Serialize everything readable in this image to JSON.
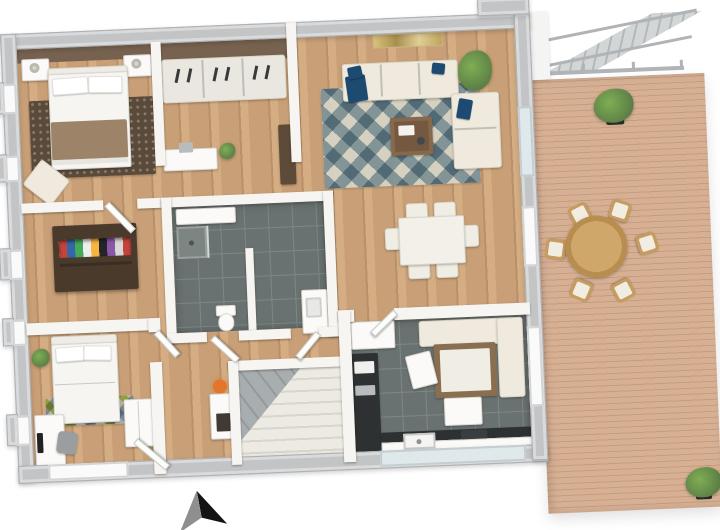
{
  "document": {
    "kind": "3d-floor-plan-rendering",
    "view": "top-down-perspective",
    "visible_text": "none"
  },
  "orientation": {
    "marker": "north-arrow",
    "direction": "up"
  },
  "colors": {
    "background": "#ffffff",
    "exterior_wall": "#c2c4c6",
    "interior_wall": "#f6f5f2",
    "wood_floor": "#c89f76",
    "wood_dark": "#b9906a",
    "wood_light": "#d4ad83",
    "deck_floor": "#d7b094",
    "deck_line": "#c49e82",
    "tile_floor": "#6a7271",
    "tile_grout": "#7e8784",
    "counter_dark": "#2d3132",
    "cream": "#efeadd",
    "navy": "#1d4a70",
    "rug_blue": "#8ba3ad",
    "rug_cream": "#eae8e0",
    "master_rug": "#5a4a3b",
    "brown_wall": "#77624f",
    "dark_wardrobe": "#4a3a2c",
    "table_brown": "#8a6e50",
    "outdoor_wood": "#c79c5e",
    "plant_green": "#5c7f46",
    "plant_light": "#7fae54",
    "lamp_orange": "#e2762d",
    "stair_gray": "#a8adaf",
    "stair_cream": "#eceae3",
    "arrow_black": "#141414",
    "arrow_gray": "#8f8f8f",
    "blanket": "#9d8469",
    "glass": "#dfe9ec"
  },
  "rooms": [
    {
      "id": "master-bedroom",
      "floor": "wood",
      "furniture": [
        "double-bed",
        "pillows",
        "taupe-blanket",
        "headboard-accent-wall",
        "nightstand-left",
        "nightstand-right",
        "table-lamps",
        "dark-patterned-rug",
        "armchair"
      ]
    },
    {
      "id": "walk-in-closet",
      "floor": "wood",
      "furniture": [
        "sliding-door-wardrobe",
        "sideboard",
        "storage-box",
        "plant",
        "tall-cabinet"
      ]
    },
    {
      "id": "living-room",
      "floor": "wood",
      "furniture": [
        "three-seat-sofa",
        "navy-cushions",
        "loveseat",
        "diamond-pattern-rug",
        "coffee-table",
        "wall-art",
        "potted-plant"
      ]
    },
    {
      "id": "dining-area",
      "floor": "wood",
      "furniture": [
        "dining-table",
        "dining-chairs"
      ]
    },
    {
      "id": "bathroom",
      "floor": "dark-tile",
      "furniture": [
        "vanity",
        "shower",
        "toilet",
        "washbasin-cabinet",
        "partition-wall"
      ]
    },
    {
      "id": "hallway",
      "floor": "wood",
      "furniture": [
        "open-wardrobe",
        "console-table",
        "orange-lamp",
        "entrance-door"
      ]
    },
    {
      "id": "bedroom-2",
      "floor": "wood",
      "furniture": [
        "bed",
        "pillows",
        "diamond-rug",
        "desk",
        "monitor",
        "desk-chair",
        "wardrobe",
        "wall-tv",
        "plant"
      ]
    },
    {
      "id": "staircase",
      "floor": "stairs",
      "furniture": [
        "winder-stairs"
      ]
    },
    {
      "id": "kitchen",
      "floor": "dark-tile",
      "furniture": [
        "corner-bench",
        "kitchen-table",
        "chairs",
        "tall-cabinet",
        "side-counter",
        "bottom-counter",
        "sink",
        "cooktop"
      ]
    },
    {
      "id": "terrace",
      "floor": "wood-decking",
      "furniture": [
        "round-dining-table",
        "outdoor-chairs",
        "potted-plants",
        "railing",
        "exterior-staircase"
      ]
    }
  ],
  "counts": {
    "terrace_chairs": 6,
    "dining_chairs": 6,
    "kitchen_chairs": 2,
    "bathroom_doors": 2,
    "left_wall_windows": 5
  }
}
